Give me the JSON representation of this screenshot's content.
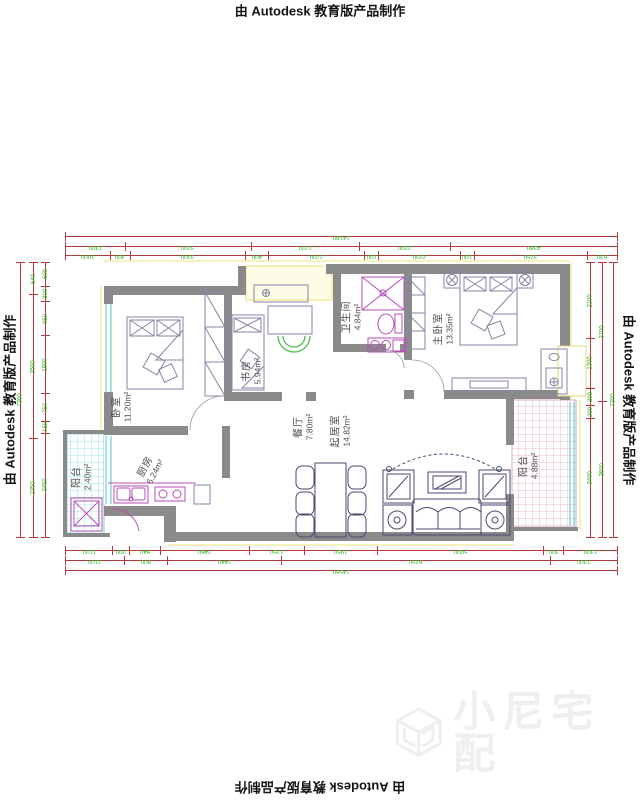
{
  "watermarks": {
    "autodesk": "由 Autodesk 教育版产品制作",
    "brand": "小尼宅配"
  },
  "rooms": [
    {
      "id": "bedroom",
      "name": "卧室",
      "area": "11.20m²"
    },
    {
      "id": "study",
      "name": "书房",
      "area": "5.94m²"
    },
    {
      "id": "bathroom",
      "name": "卫生间",
      "area": "4.84m²"
    },
    {
      "id": "master-bedroom",
      "name": "主卧室",
      "area": "13.35m²"
    },
    {
      "id": "dining-room",
      "name": "餐厅",
      "area": "7.80m²"
    },
    {
      "id": "living-room",
      "name": "起居室",
      "area": "14.82m²"
    },
    {
      "id": "kitchen",
      "name": "厨房",
      "area": "6.24m²"
    },
    {
      "id": "balcony-left",
      "name": "阳台",
      "area": "2.40m²"
    },
    {
      "id": "balcony-right",
      "name": "阳台",
      "area": "4.88m²"
    }
  ],
  "dimensions": {
    "top": {
      "total": [
        "14180"
      ],
      "row2": [
        "1300",
        "3200",
        "2700",
        "2200",
        "4380"
      ],
      "row3": [
        "1000",
        "300",
        "3300",
        "400",
        "2700",
        "100",
        "2200",
        "100",
        "3250",
        "630"
      ]
    },
    "bottom": {
      "inner": [
        "1100",
        "200",
        "640",
        "2460",
        "1350",
        "1950",
        "5000",
        "300",
        "1300"
      ],
      "middle": [
        "1100",
        "800",
        "2440",
        "6250",
        "1300"
      ],
      "total": [
        "14580"
      ]
    },
    "left": {
      "outer": [
        "7300"
      ],
      "middle": [
        "640",
        "3500",
        "2350"
      ],
      "inner": [
        "600",
        "300",
        "950",
        "1800",
        "750",
        "150",
        "3450"
      ]
    },
    "right": {
      "inner": [
        "2100",
        "1300",
        "300",
        "200",
        "3400"
      ],
      "middle": [
        "3700",
        "3600"
      ],
      "outer": [
        "7300"
      ]
    }
  },
  "colors": {
    "wall": "#8a8a8a",
    "dim_line": "#b23a3a",
    "dim_text": "#1db41d",
    "fixture": "#b84db8",
    "window": "#4fc3cf",
    "furniture": "#8585a5",
    "furniture_dark": "#4a4a70",
    "door_arc": "#55bb55",
    "tile_cyan": "#a5e6e6",
    "tile_pink": "#e6bcc8",
    "accent_yellow": "#ece27a",
    "label": "#4d4d4d",
    "watermark": "#efefef"
  }
}
